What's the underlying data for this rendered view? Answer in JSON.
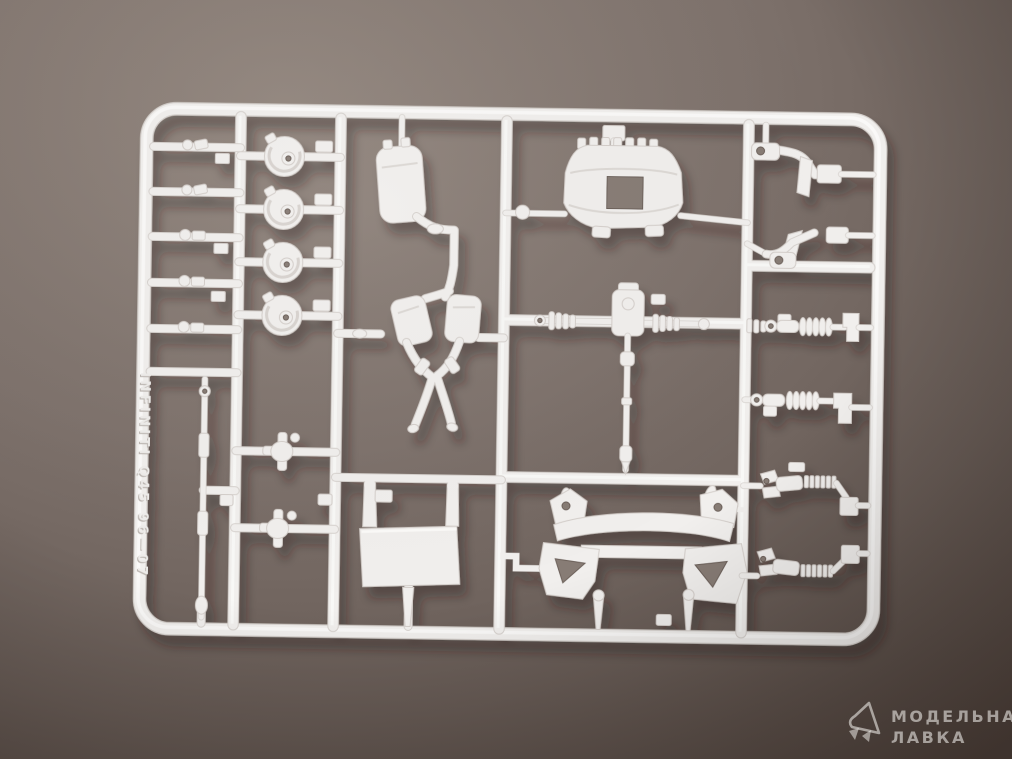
{
  "scene": {
    "type": "photograph",
    "subject": "white-polystyrene-model-kit-sprue-with-car-chassis-parts-on-brown-backdrop",
    "backdrop_top_color": "#93877f",
    "backdrop_mid_color": "#7e726c",
    "backdrop_bottom_color": "#4e423c",
    "plastic_color": "#f1efed",
    "plastic_edge_color": "#d6d1cd"
  },
  "sprue": {
    "embossed_code": "INFINITI Q45 96—07",
    "parts": [
      "engine-valve-cover",
      "exhaust-system-with-mufflers",
      "front-subframe-crossmember",
      "differential-with-driveshaft",
      "cv-axle-shafts",
      "coil-over-shock-absorbers",
      "suspension-arms",
      "brake-disc-hubs",
      "stabilizer-bar",
      "undertray-plate",
      "small-clips-and-mounts"
    ]
  },
  "watermark": {
    "line1": "МОДЕЛЬНАЯ",
    "line2": "ЛАВКА",
    "logo": "paper-plane-logo",
    "text_color": "rgba(250,247,244,0.55)"
  }
}
